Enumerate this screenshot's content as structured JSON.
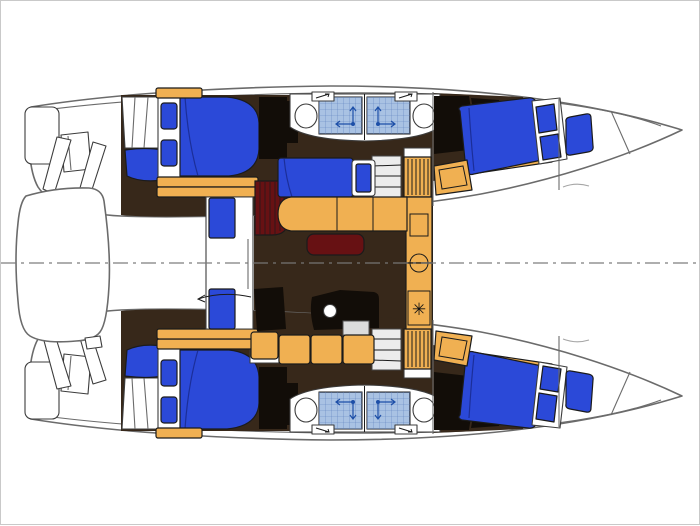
{
  "meta": {
    "title": "Catamaran interior layout floor plan",
    "view": "top-down deck plan",
    "visible_text": "none"
  },
  "symbols": {
    "stove_burner": "✳"
  },
  "features": [
    "port-hull",
    "starboard-hull",
    "aft-double-cabin",
    "forward-double-cabin",
    "shower-compartment",
    "toilet",
    "deck-hatch",
    "hull-stairs",
    "louvered-cabinet",
    "saloon-sofa",
    "saloon-table",
    "settee-berth",
    "galley-counter",
    "galley-sink",
    "stove",
    "cockpit-door",
    "cockpit-seat",
    "dinghy-on-davits",
    "transom-steps",
    "forepeak-cushion",
    "boat-centerline"
  ],
  "colors": {
    "white": "#ffffff",
    "page_border": "#c9c9c9",
    "outline": "#6b6b6b",
    "stroke_mid": "#3c3c3c",
    "stroke_dark": "#1b1b1b",
    "floor_brown": "#37281a",
    "cabinet_black": "#120d08",
    "bed_blue": "#2b49d8",
    "bed_blue_dark": "#16247f",
    "wood_orange": "#f0b052",
    "table_maroon": "#671113",
    "tile_blue": "#a9c2e3",
    "tile_grid": "#5d7fbe",
    "symbol_blue": "#1d4fa8",
    "appliance_gray": "#dcdcdc",
    "stairs_gray": "#ececec",
    "centerline": "#787878"
  }
}
